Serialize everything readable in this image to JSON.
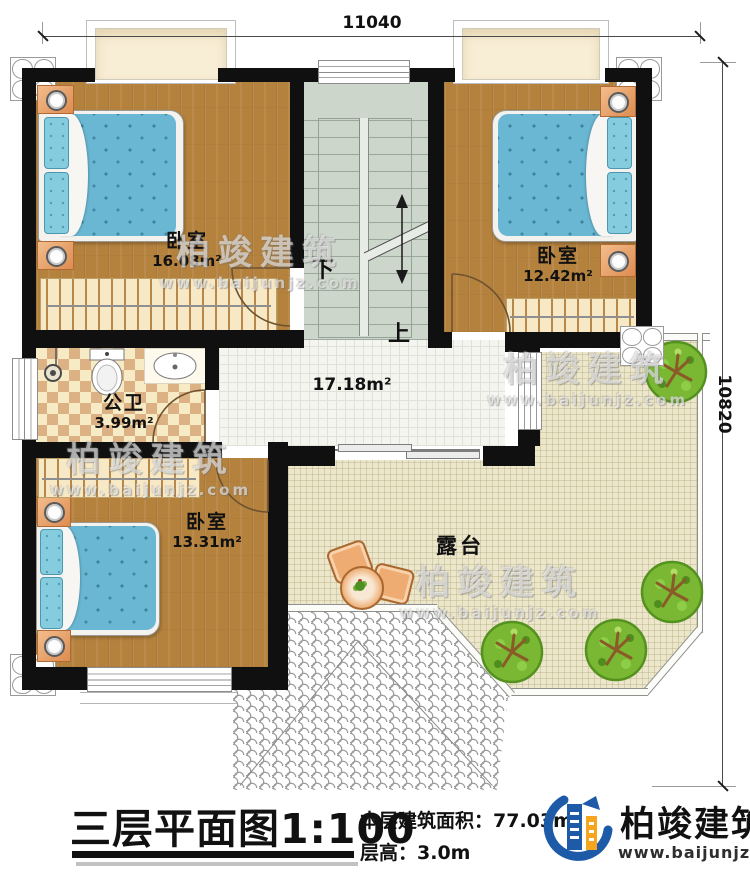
{
  "dimensions": {
    "width_label": "11040",
    "height_label": "10820"
  },
  "rooms": {
    "bedroom_top_left": {
      "name": "卧室",
      "area": "16.08m²"
    },
    "bedroom_top_right": {
      "name": "卧室",
      "area": "12.42m²"
    },
    "bedroom_bottom_left": {
      "name": "卧室",
      "area": "13.31m²"
    },
    "bathroom": {
      "name": "公卫",
      "area": "3.99m²"
    },
    "hall": {
      "area": "17.18m²"
    },
    "terrace": {
      "name": "露台"
    },
    "stairs": {
      "down_label": "下",
      "up_label": "上"
    }
  },
  "title_block": {
    "title": "三层平面图",
    "scale": "1:100",
    "floor_area_label": "本层建筑面积：",
    "floor_area_value": "77.03m²",
    "floor_height_label": "层高：",
    "floor_height_value": "3.0m"
  },
  "brand": {
    "name": "柏竣建筑",
    "website": "www.baijunjz.com"
  },
  "watermark": {
    "name": "柏竣建筑",
    "website": "www.baijunjz.com"
  },
  "colors": {
    "wall": "#101010",
    "wood": "#b5823e",
    "mattress": "#69b7d3",
    "terrace": "#ece6cb",
    "stairs": "#ccd6ca",
    "brand_blue": "#1d5ba8",
    "brand_orange": "#f5a51e"
  }
}
